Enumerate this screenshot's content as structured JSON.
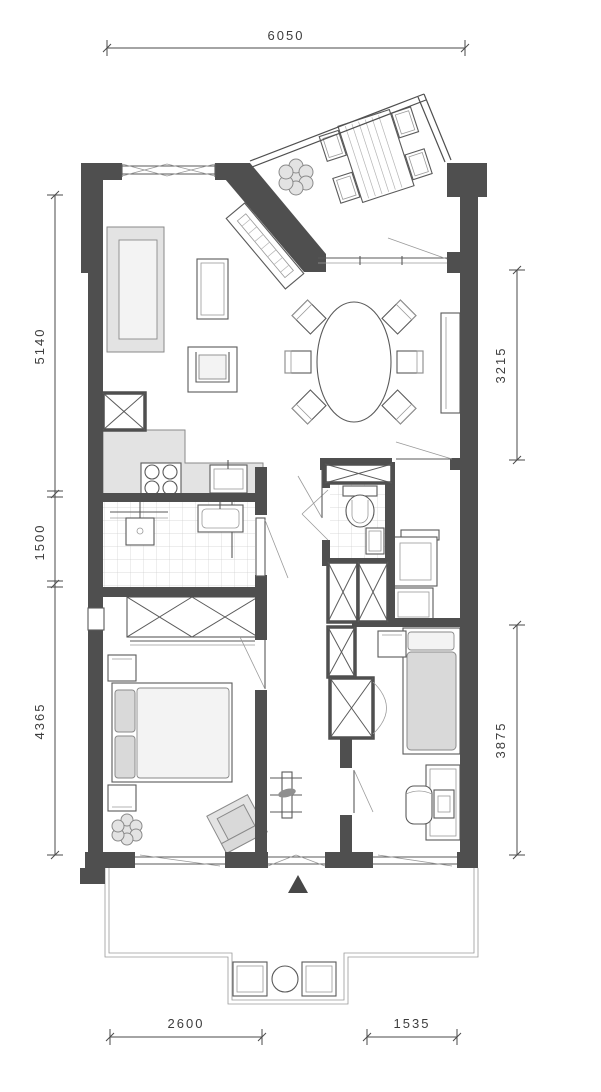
{
  "colors": {
    "wall": "#4f4f4f",
    "line": "#5a5a5a",
    "dim_line": "#4a4a4a",
    "dim_text": "#3d3d3d",
    "furniture_fill": "#e3e3e3",
    "mattress_fill": "#dcdcdc",
    "tile_line": "#cfcfcf",
    "background": "#ffffff",
    "entrance_arrow": "#474747"
  },
  "dimensions": {
    "top": {
      "overall_width": "6050"
    },
    "left": {
      "segments": [
        "5140",
        "1500",
        "4365"
      ]
    },
    "right": {
      "segments": [
        "3215",
        "3875"
      ]
    },
    "bottom": {
      "segments": [
        "2600",
        "1535"
      ]
    }
  }
}
